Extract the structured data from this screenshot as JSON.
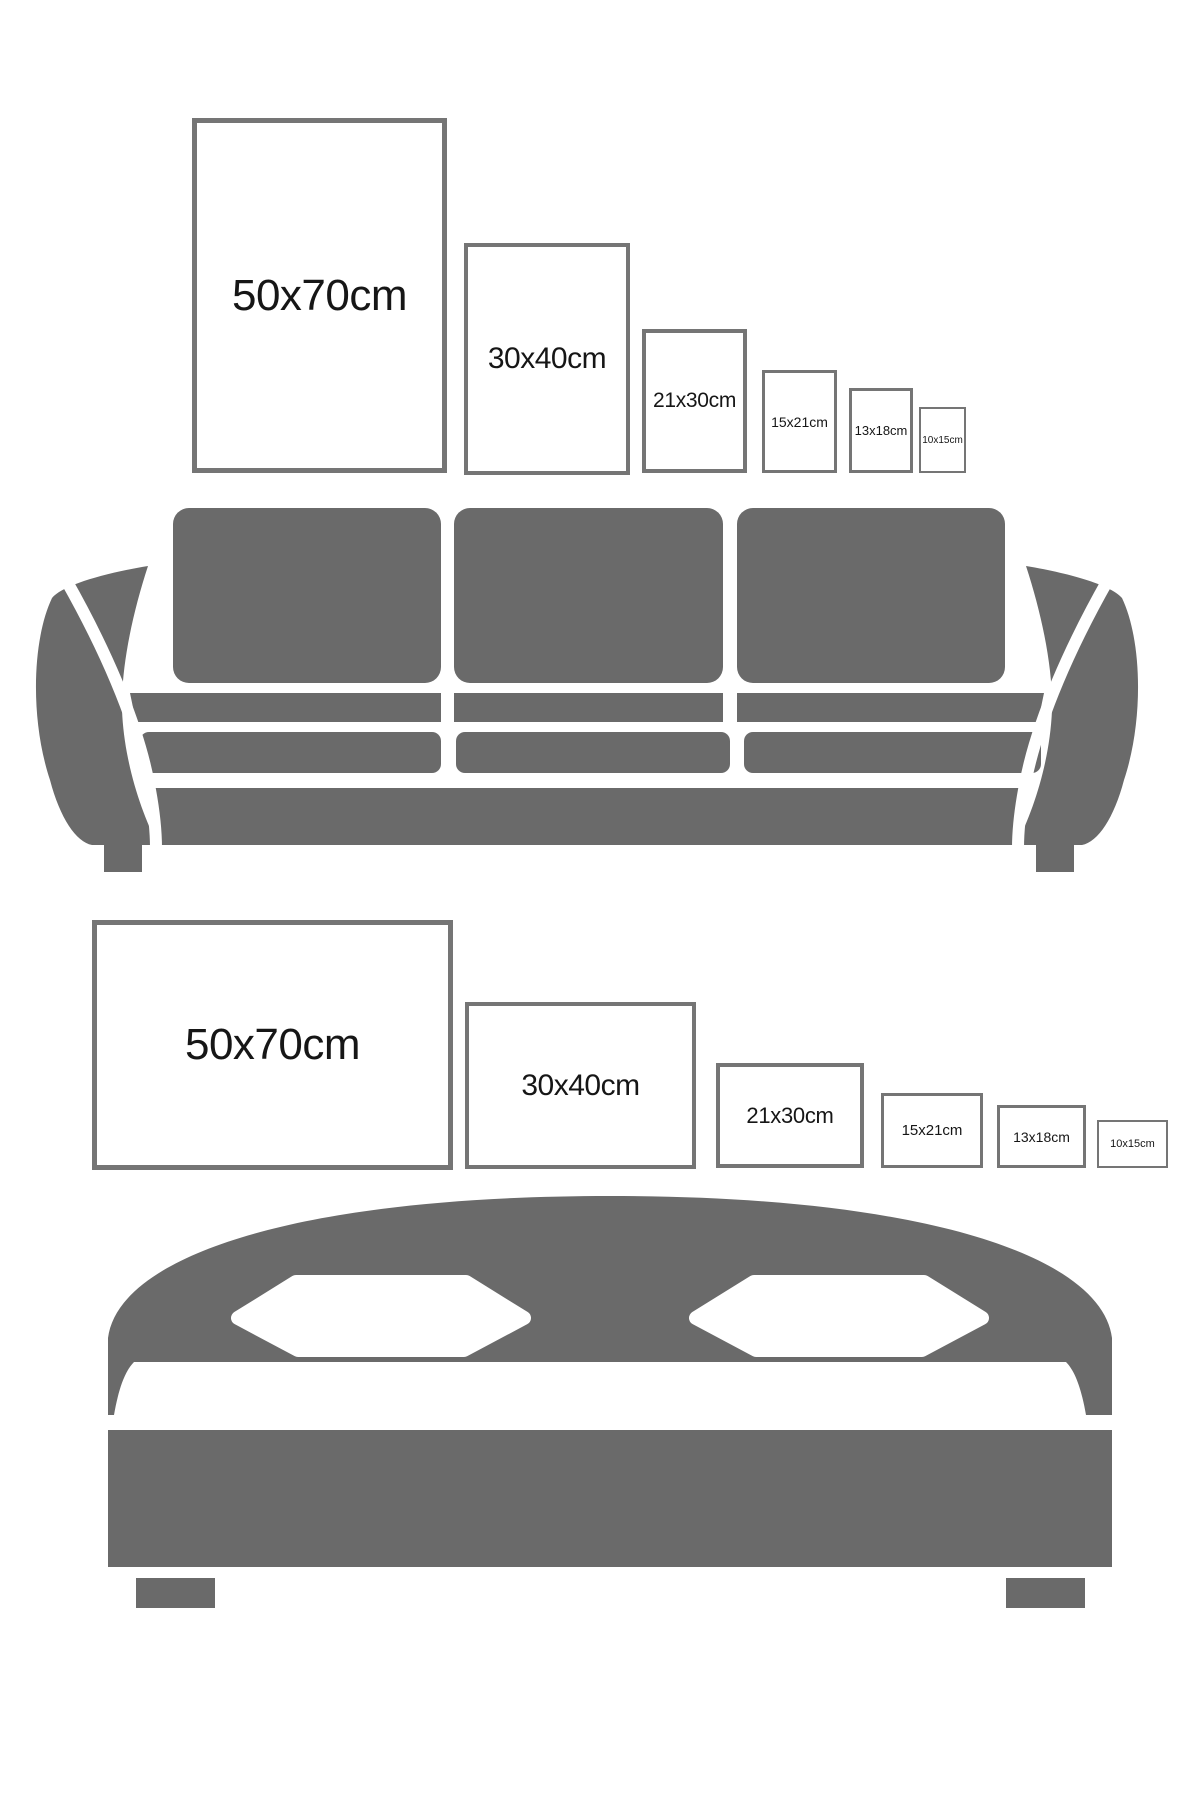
{
  "colors": {
    "furniture_gray": "#6a6a6a",
    "frame_border": "#757575",
    "label_color": "#161616",
    "background": "#ffffff"
  },
  "portrait_frames": [
    {
      "label": "50x70cm"
    },
    {
      "label": "30x40cm"
    },
    {
      "label": "21x30cm"
    },
    {
      "label": "15x21cm"
    },
    {
      "label": "13x18cm"
    },
    {
      "label": "10x15cm"
    }
  ],
  "landscape_frames": [
    {
      "label": "50x70cm"
    },
    {
      "label": "30x40cm"
    },
    {
      "label": "21x30cm"
    },
    {
      "label": "15x21cm"
    },
    {
      "label": "13x18cm"
    },
    {
      "label": "10x15cm"
    }
  ]
}
